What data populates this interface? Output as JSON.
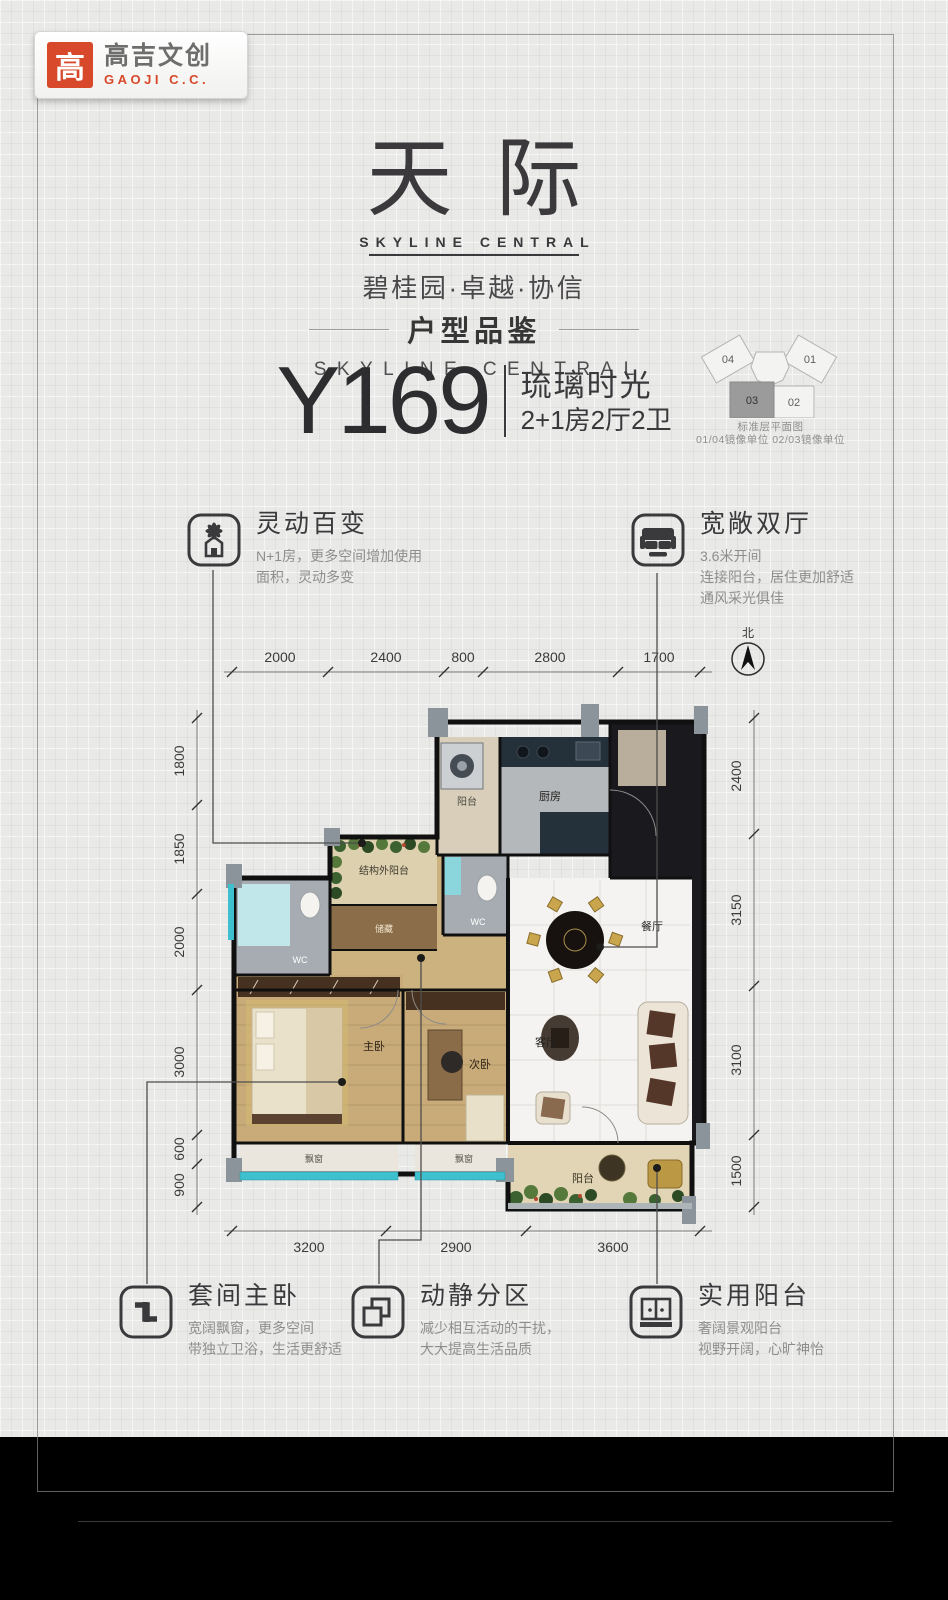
{
  "logo": {
    "mark": "高",
    "name": "高吉文创",
    "sub": "GAOJI C.C."
  },
  "hero": {
    "title": "天际",
    "title_en": "SKYLINE CENTRAL",
    "brands": "碧桂园·卓越·协信"
  },
  "section": {
    "heading": "户型品鉴",
    "heading_en": "SKYLINE CENTRAL",
    "code": "Y169",
    "name": "琉璃时光",
    "spec": "2+1房2厅2卫"
  },
  "keyplan": {
    "u01": "01",
    "u02": "02",
    "u03": "03",
    "u04": "04",
    "caption1": "标准层平面图",
    "caption2": "01/04镜像单位 02/03镜像单位"
  },
  "features_top": [
    {
      "icon": "flower-house-icon",
      "title": "灵动百变",
      "desc": "N+1房，更多空间增加使用\n面积，灵动多变"
    },
    {
      "icon": "sofa-icon",
      "title": "宽敞双厅",
      "desc": "3.6米开间\n连接阳台，居住更加舒适\n通风采光俱佳"
    }
  ],
  "features_bottom": [
    {
      "icon": "pinwheel-arrows-icon",
      "title": "套间主卧",
      "desc": "宽阔飘窗，更多空间\n带独立卫浴，生活更舒适"
    },
    {
      "icon": "overlap-squares-icon",
      "title": "动静分区",
      "desc": "减少相互活动的干扰，\n大大提高生活品质"
    },
    {
      "icon": "balcony-window-icon",
      "title": "实用阳台",
      "desc": "奢阔景观阳台\n视野开阔，心旷神怡"
    }
  ],
  "floorplan": {
    "compass": "北",
    "dims_top": [
      "2000",
      "2400",
      "800",
      "2800",
      "1700"
    ],
    "dims_left": [
      "1800",
      "1850",
      "2000",
      "3000",
      "600",
      "900"
    ],
    "dims_right": [
      "2400",
      "3150",
      "3100",
      "1500"
    ],
    "dims_bottom": [
      "3200",
      "2900",
      "3600"
    ],
    "rooms": {
      "utility_balcony": "阳台",
      "kitchen": "厨房",
      "wc_kitchen": "WC",
      "dining": "餐厅",
      "outer_balcony": "结构外阳台",
      "storage": "储藏",
      "wc_master": "WC",
      "master_bedroom": "主卧",
      "second_bedroom": "次卧",
      "living": "客厅",
      "bay_window_master": "飘窗",
      "bay_window_second": "飘窗",
      "balcony": "阳台"
    }
  },
  "colors": {
    "accent_red": "#d7492a",
    "ink": "#3a3a3c",
    "teal_window": "#3ec0cf",
    "wall": "#101010"
  }
}
